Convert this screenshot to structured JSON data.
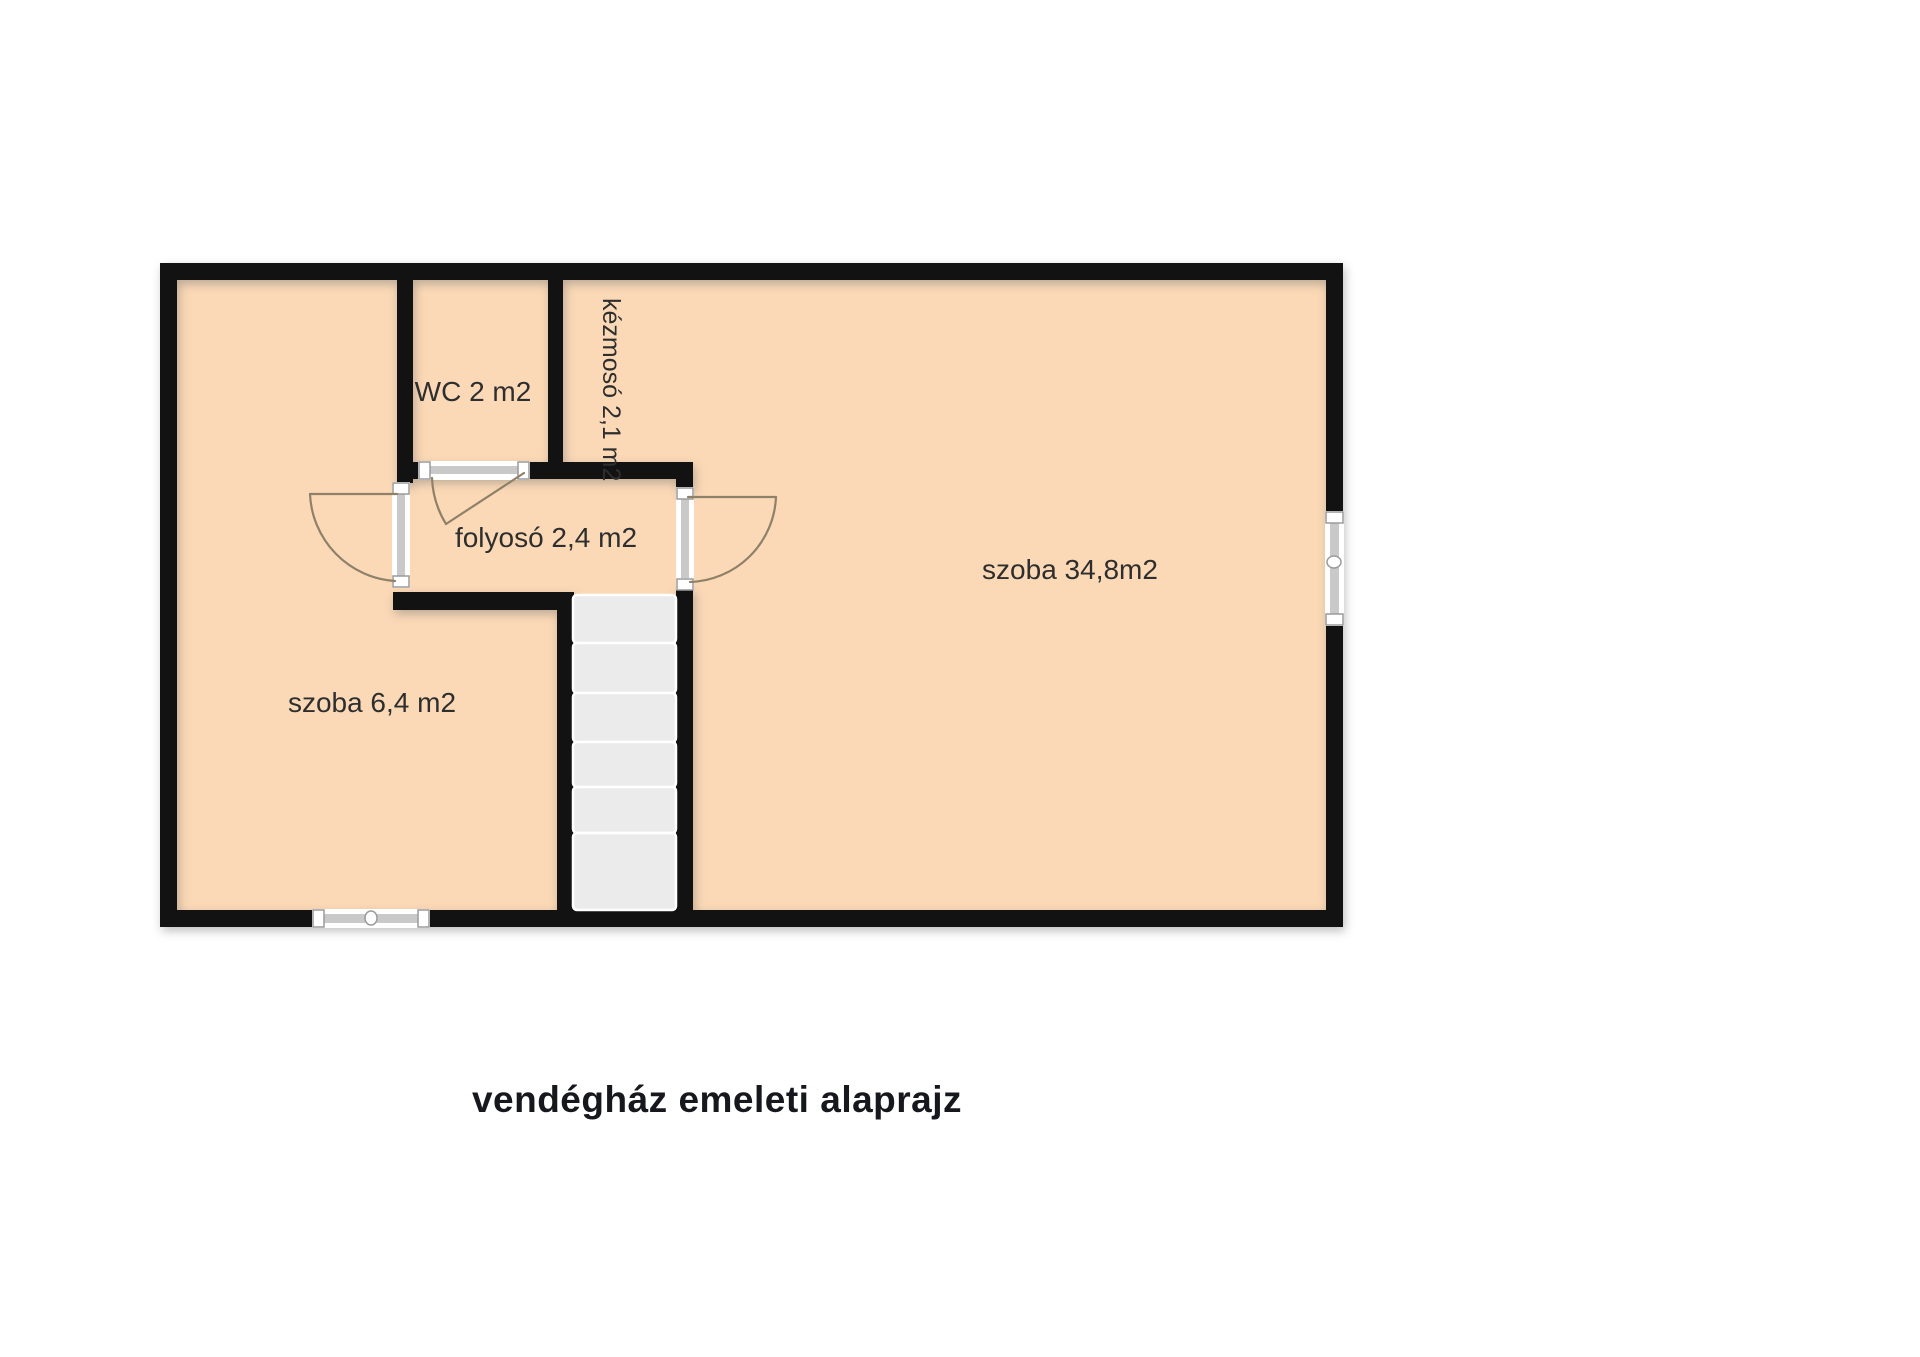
{
  "title": {
    "text": "vendégház emeleti alaprajz"
  },
  "rooms": {
    "szoba_small": {
      "label": "szoba 6,4 m2"
    },
    "wc": {
      "label": "WC 2 m2"
    },
    "kezmoso": {
      "label": "kézmosó 2,1 m2"
    },
    "folyoso": {
      "label": "folyosó 2,4 m2"
    },
    "szoba_large": {
      "label": "szoba 34,8m2"
    }
  },
  "colors": {
    "canvas": "#ffffff",
    "floor": "#fbd9b6",
    "wall": "#121212",
    "stair": "#ebebeb",
    "stairline": "#ffffff",
    "fixgray": "#c9c9c9",
    "fixwhite": "#ffffff",
    "fixline": "#9a9a9a",
    "swing": "#8f8069",
    "label": "#2e2e2e",
    "titlecolor": "#16181d"
  },
  "stairs": {
    "x": 573,
    "width": 103,
    "tread_boundaries": [
      595,
      643,
      693,
      742,
      787,
      833,
      910
    ]
  }
}
